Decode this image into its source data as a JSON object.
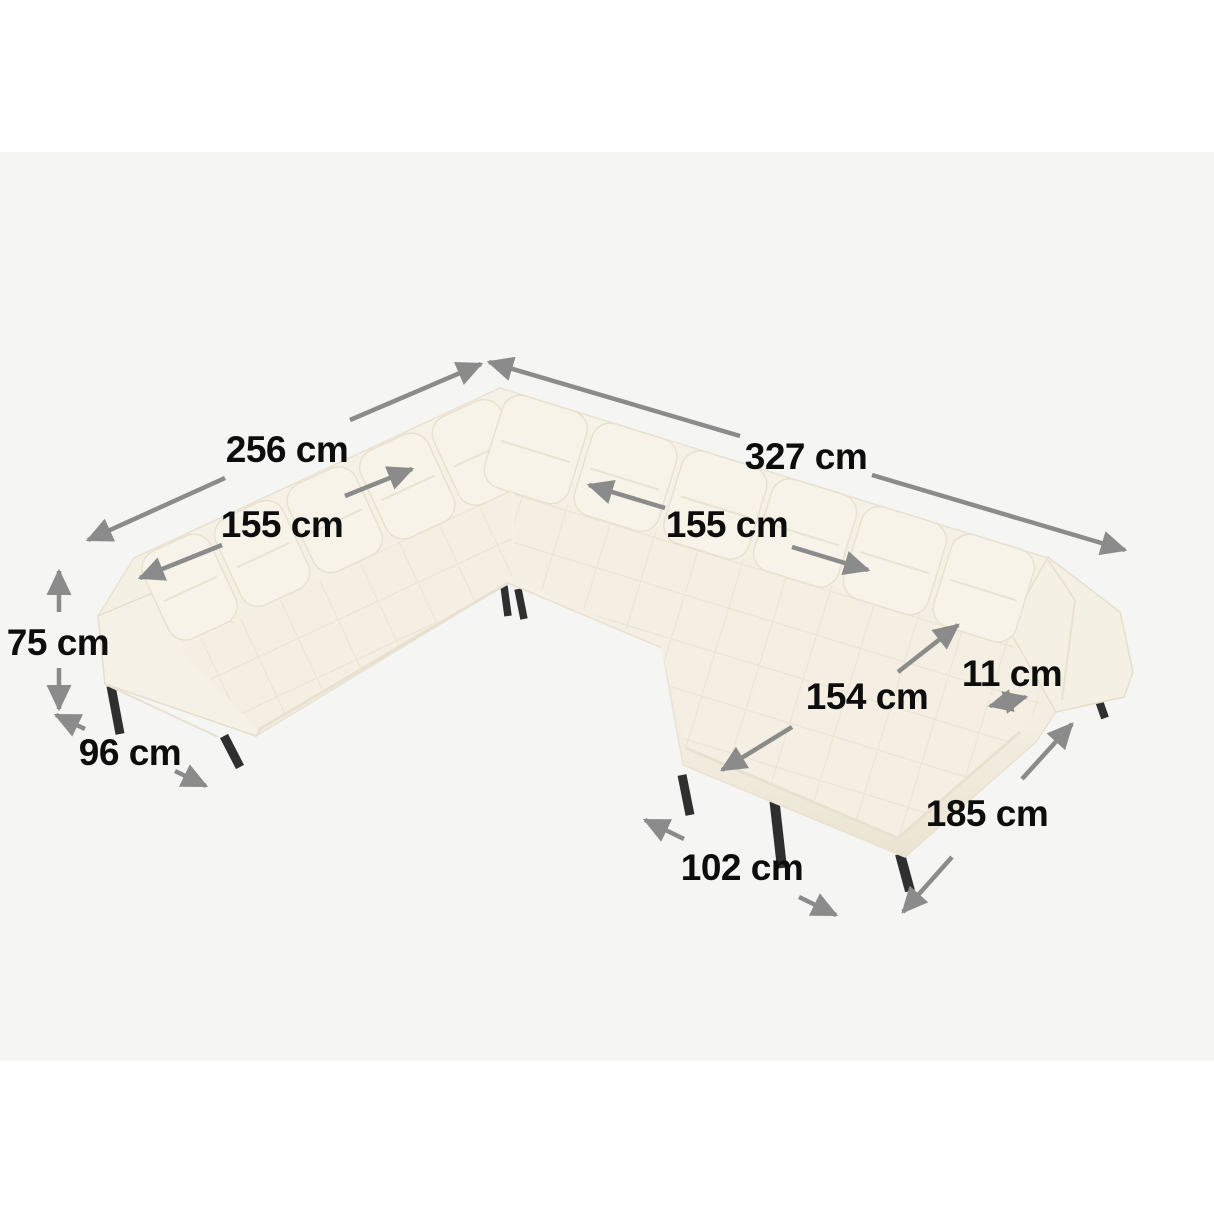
{
  "scene": {
    "description": "dimension diagram of a u-shaped tufted panoramic corner sofa with black metal legs",
    "colors": {
      "page": "#ffffff",
      "canvas": "#f5f5f3",
      "arrow": "#8b8b8b",
      "label": "#0d0d0d",
      "sofa-base": "#f3eee1",
      "sofa-light": "#f8f4ea",
      "sofa-shade": "#ece5d4",
      "seam": "#e8e1d0",
      "leg": "#2f2f2f"
    }
  },
  "dimensions": {
    "left_back_total": "256 cm",
    "right_back_total": "327 cm",
    "left_seat_width": "155 cm",
    "right_seat_width": "155 cm",
    "height": "75 cm",
    "depth": "96 cm",
    "chaise_length": "154 cm",
    "armrest_width": "11 cm",
    "right_side_total": "185 cm",
    "chaise_width": "102 cm"
  }
}
